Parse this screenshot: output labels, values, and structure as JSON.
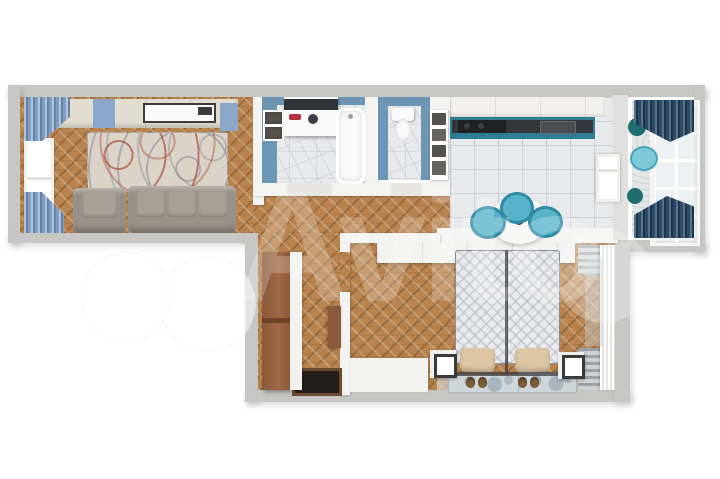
{
  "watermark": {
    "text": "Avito"
  },
  "colors": {
    "bg": "#ffffff",
    "wallOuter": "#c6c6c4",
    "wallInner": "#f3f3f1",
    "parquet": "#b8834e",
    "marble": "#e8e9eb",
    "bathWallBlue": "#6d96b5",
    "kitchenTeal": "#2e7d92",
    "countertop": "#33363b",
    "stove": "#1f2125",
    "chairTeal": "#58b2ca",
    "chairTealDark": "#2f8aa3",
    "tableWhite": "#f6f6f4",
    "curtainBlue": "#7f9cc2",
    "curtainNavy": "#2c4a66",
    "rugCream": "#dbd3c7",
    "sofaGray": "#9a9289",
    "sofaGrayLight": "#a8a096",
    "cabinetCream": "#e2ddcf",
    "accentBluePanel": "#8ba6c9",
    "fixtureWhite": "#fafafa",
    "washerDark": "#2f3338",
    "washerRed": "#b23040",
    "woodBrown": "#8a5a3a",
    "doormat": "#241d18",
    "doormatEdge": "#6b4a30",
    "bedDuvet": "#e9eaed",
    "pillowBeige": "#dcc6a4",
    "slipperBrown": "#7d5c38",
    "nightstandFrame": "#3a3a3a",
    "radiator": "#9aa0a6",
    "radiatorLight": "#cdd1d4",
    "bedroomRug": "#cfd6da",
    "balconyFloor": "#e3e6e6",
    "glazingPane": "#eef1f2",
    "tealDecorDark": "#1e6e70",
    "tealDecorLight": "#7cc8d8",
    "thresholdFloor": "#e8e6e2",
    "acDark": "#3c3c3c"
  },
  "scene": {
    "type": "3d-floor-plan",
    "rooms": [
      "living-room",
      "bathroom",
      "wc",
      "kitchen",
      "balcony",
      "hallway",
      "bedroom"
    ],
    "furniture": [
      "sofa",
      "armchair",
      "rug",
      "ac-unit",
      "window",
      "curtains",
      "shelves",
      "washing-machine",
      "bathtub",
      "toilet",
      "kitchen-counter",
      "upper-cabinets",
      "stove",
      "dining-table",
      "chairs",
      "wardrobe",
      "doormat",
      "bed",
      "pillows",
      "slippers",
      "nightstands",
      "radiators",
      "bedroom-rugs",
      "balcony-glazing",
      "balcony-stools"
    ]
  }
}
